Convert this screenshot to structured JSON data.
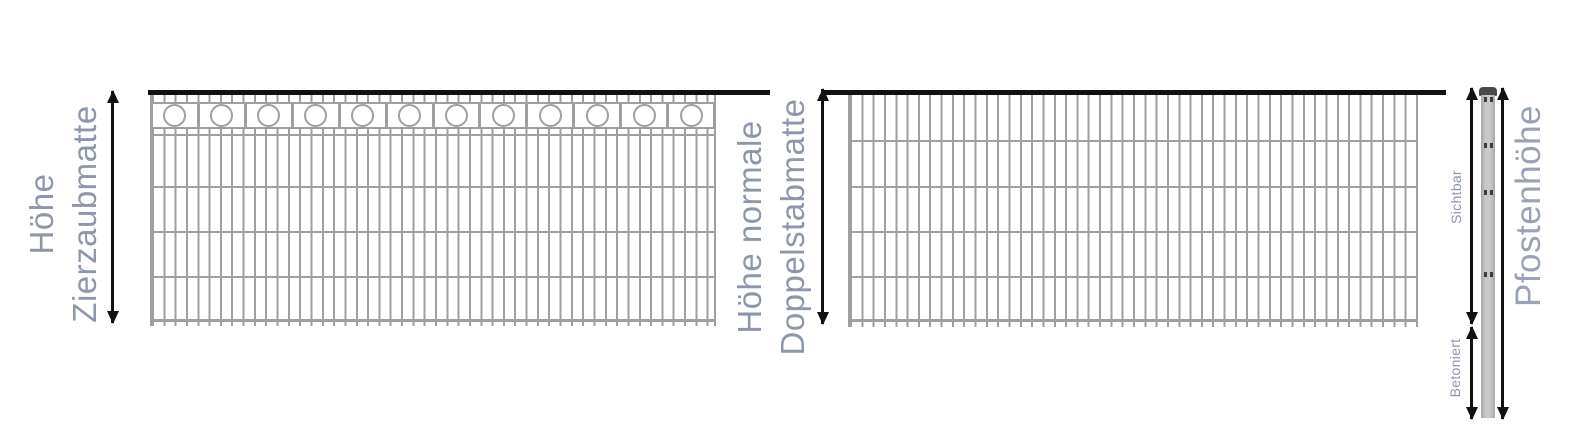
{
  "diagram": {
    "labels": {
      "zier": {
        "line1": "Höhe",
        "line2": "Zierzaubmatte"
      },
      "doppel": {
        "line1": "Höhe normale",
        "line2": "Doppelstabmatte"
      },
      "pfosten": "Pfostenhöhe",
      "sichtbar": "Sichtbar",
      "betoniert": "Betoniert"
    },
    "left_panel": {
      "ring_count": 12
    },
    "colors": {
      "label": "#8d96aa",
      "label-light": "#9aa3b5",
      "wire": "#9f9f9f",
      "rail": "#111111",
      "arrow": "#111111",
      "post-body": "#bcbcbc",
      "post-cap": "#4a4a4a",
      "bg": "#ffffff"
    }
  }
}
